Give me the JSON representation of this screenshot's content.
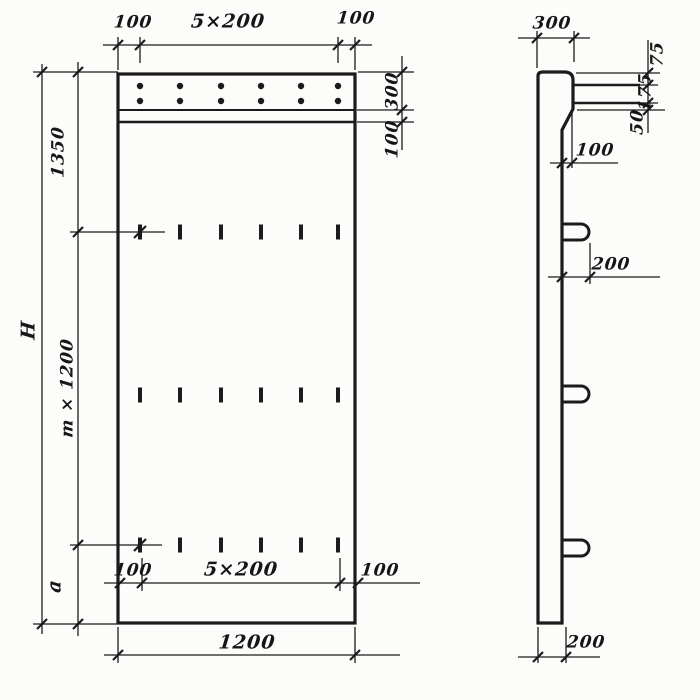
{
  "front_view": {
    "dim_top_left": "100",
    "dim_top_span": "5×200",
    "dim_top_right": "100",
    "dim_right_top_strip": "300",
    "dim_right_sub_strip": "100",
    "dim_left_upper": "1350",
    "dim_left_total_height": "H",
    "dim_left_module": "m × 1200",
    "dim_left_lower": "a",
    "dim_bottom_inner_left": "100",
    "dim_bottom_inner_span": "5×200",
    "dim_bottom_inner_right": "100",
    "dim_bottom_overall_width": "1200"
  },
  "side_view": {
    "dim_top_width": "300",
    "dim_right_upper": "75",
    "dim_right_middle": "175",
    "dim_right_lower": "50",
    "dim_face_step": "100",
    "dim_loop_protrusion": "200",
    "dim_bottom_thickness": "200"
  }
}
